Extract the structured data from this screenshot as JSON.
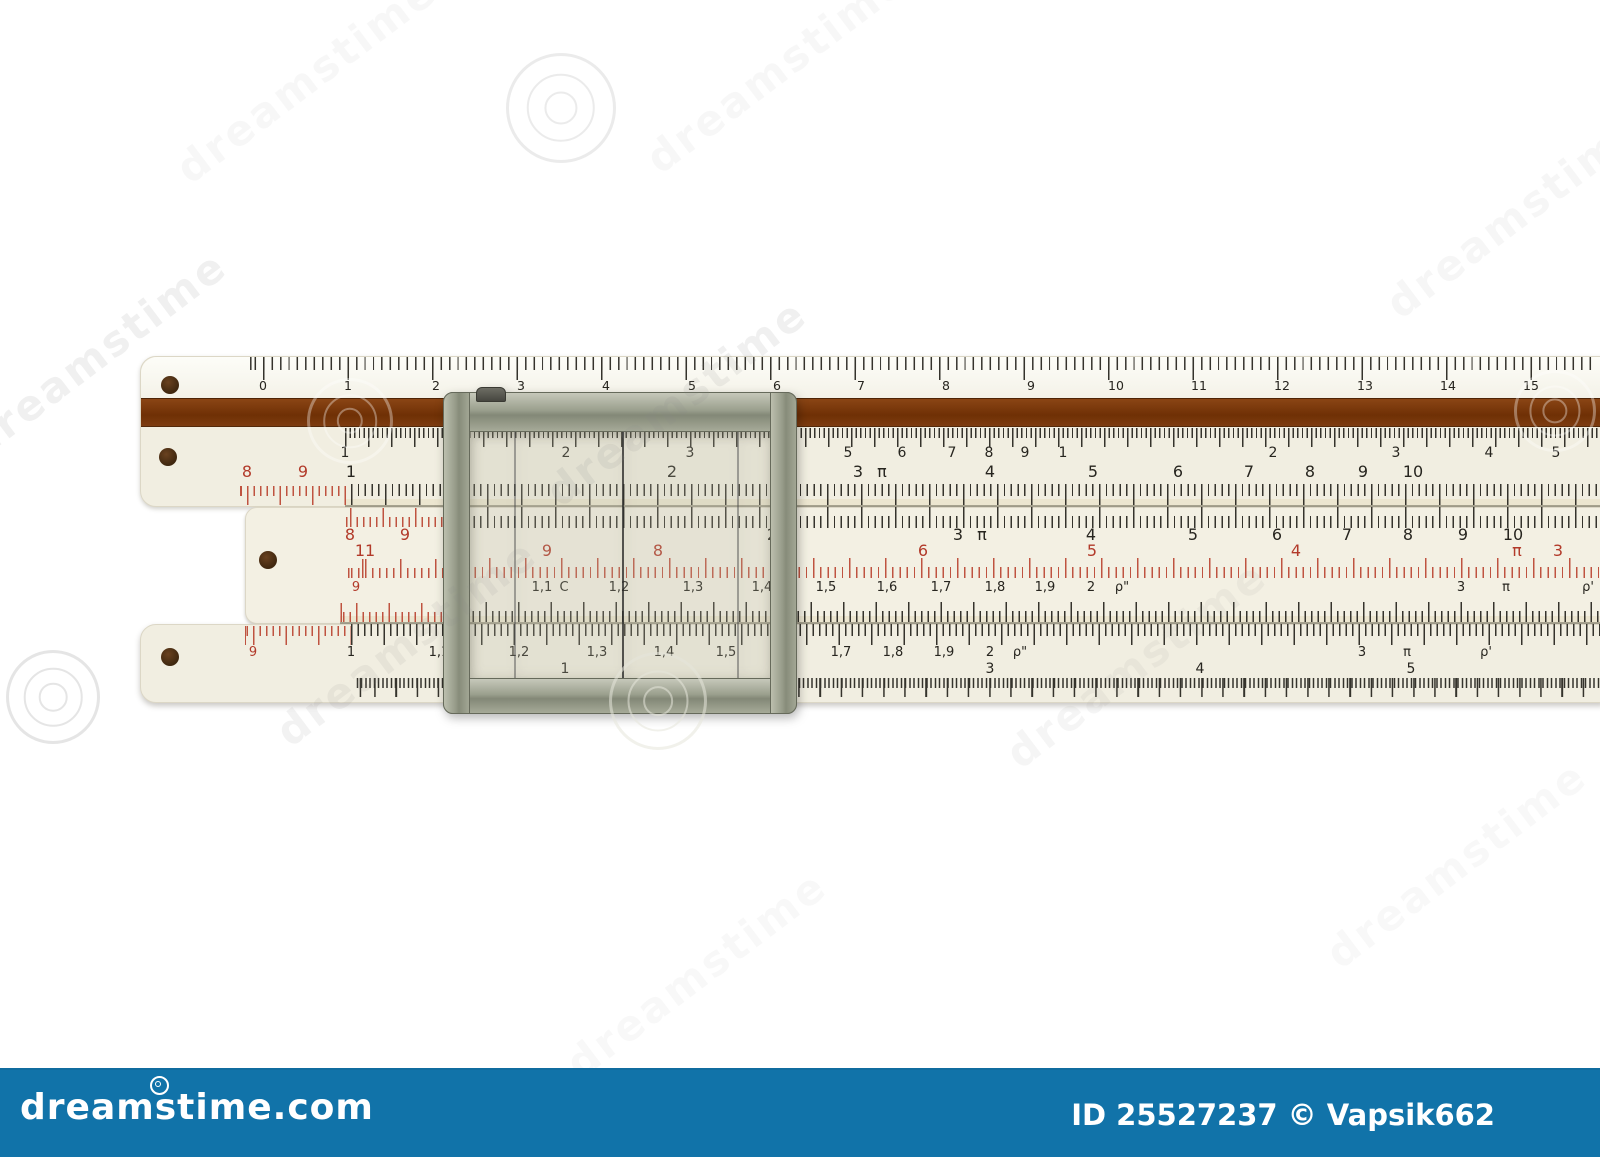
{
  "footer": {
    "logo": "dreamstime.com",
    "credit": "ID 25527237 © Vapsik662",
    "bar_color": "#1173a9"
  },
  "colors": {
    "background": "#ffffff",
    "ivory": "#f1eee1",
    "wood_brown": "#7b3a10",
    "tick_black": "#35332c",
    "tick_red": "#bf5340",
    "label_black": "#27251f",
    "label_red": "#b23a2a",
    "metal": "#9ba08e",
    "bar_blue": "#1173a9",
    "hole_brown": "#4f2e13"
  },
  "watermarks": {
    "text": "dreamstime",
    "texts": [
      {
        "x": 150,
        "y": 55,
        "o": 0.06
      },
      {
        "x": 620,
        "y": 45,
        "o": 0.06
      },
      {
        "x": -60,
        "y": 330,
        "o": 0.12
      },
      {
        "x": 520,
        "y": 378,
        "o": 0.12
      },
      {
        "x": 1360,
        "y": 190,
        "o": 0.07
      },
      {
        "x": 250,
        "y": 618,
        "o": 0.1
      },
      {
        "x": 980,
        "y": 640,
        "o": 0.08
      },
      {
        "x": 540,
        "y": 950,
        "o": 0.05
      },
      {
        "x": 1300,
        "y": 840,
        "o": 0.05
      }
    ],
    "spirals": [
      {
        "x": 558,
        "y": 105,
        "r": 52,
        "c": "rgba(190,190,190,0.30)"
      },
      {
        "x": 347,
        "y": 418,
        "r": 40,
        "c": "rgba(255,255,255,0.35)"
      },
      {
        "x": 1552,
        "y": 408,
        "r": 38,
        "c": "rgba(255,255,255,0.35)"
      },
      {
        "x": 50,
        "y": 694,
        "r": 44,
        "c": "rgba(160,160,160,0.28)"
      },
      {
        "x": 655,
        "y": 698,
        "r": 46,
        "c": "rgba(230,230,218,0.55)"
      }
    ]
  },
  "holes": [
    {
      "x": 170,
      "y": 385
    },
    {
      "x": 168,
      "y": 457
    },
    {
      "x": 268,
      "y": 560
    },
    {
      "x": 170,
      "y": 657
    }
  ],
  "strips": [
    {
      "x1": 345,
      "x2": 1600,
      "y": 499,
      "h": 7
    },
    {
      "x1": 340,
      "x2": 1600,
      "y": 616,
      "h": 7
    }
  ],
  "joints": [
    {
      "x1": 345,
      "x2": 1600,
      "y": 505
    },
    {
      "x1": 340,
      "x2": 1600,
      "y": 622
    }
  ],
  "bands": [
    {
      "id": "cm-ticks",
      "x1": 250,
      "x2": 1598,
      "y": 357,
      "h": 23,
      "minor": 8.45,
      "major": 84.5,
      "anchor": 263,
      "color": "black",
      "align": "top"
    },
    {
      "id": "cube-ticks",
      "x1": 345,
      "x2": 1600,
      "y": 428,
      "h": 19,
      "minor": 4.6,
      "major": 23,
      "anchor": 345,
      "color": "black",
      "align": "top"
    },
    {
      "id": "stator-ticks",
      "x1": 351,
      "x2": 1600,
      "y": 484,
      "h": 21,
      "minor": 6.8,
      "major": 34,
      "anchor": 351,
      "color": "black",
      "align": "top"
    },
    {
      "id": "stator-red-ext",
      "x1": 240,
      "x2": 351,
      "y": 486,
      "h": 19,
      "minor": 6.5,
      "major": 32.5,
      "anchor": 247,
      "color": "red",
      "align": "top"
    },
    {
      "id": "slide-top-ticks",
      "x1": 453,
      "x2": 1600,
      "y": 507,
      "h": 21,
      "minor": 6.8,
      "major": 34,
      "anchor": 453,
      "color": "black",
      "align": "bottom"
    },
    {
      "id": "slide-red-ext",
      "x1": 345,
      "x2": 453,
      "y": 508,
      "h": 19,
      "minor": 6.5,
      "major": 32.5,
      "anchor": 350,
      "color": "red",
      "align": "bottom"
    },
    {
      "id": "inverse-ticks",
      "x1": 453,
      "x2": 1600,
      "y": 558,
      "h": 20,
      "minor": 7.2,
      "major": 36,
      "anchor": 453,
      "color": "red",
      "align": "bottom"
    },
    {
      "id": "inverse-ext",
      "x1": 345,
      "x2": 453,
      "y": 559,
      "h": 19,
      "minor": 7,
      "major": 35,
      "anchor": 365,
      "color": "red",
      "align": "bottom"
    },
    {
      "id": "c-ticks",
      "x1": 453,
      "x2": 1600,
      "y": 602,
      "h": 20,
      "minor": 6.5,
      "major": 32.5,
      "anchor": 453,
      "color": "black",
      "align": "bottom"
    },
    {
      "id": "c-red-ext",
      "x1": 340,
      "x2": 453,
      "y": 603,
      "h": 19,
      "minor": 6.5,
      "major": 32.5,
      "anchor": 356,
      "color": "red",
      "align": "bottom"
    },
    {
      "id": "d-ticks",
      "x1": 351,
      "x2": 1600,
      "y": 624,
      "h": 21,
      "minor": 6.5,
      "major": 32.5,
      "anchor": 351,
      "color": "black",
      "align": "top"
    },
    {
      "id": "d-red-ext",
      "x1": 245,
      "x2": 351,
      "y": 626,
      "h": 19,
      "minor": 6.5,
      "major": 32.5,
      "anchor": 253,
      "color": "red",
      "align": "top"
    },
    {
      "id": "lg-ticks",
      "x1": 356,
      "x2": 1600,
      "y": 678,
      "h": 19,
      "minor": 4.25,
      "major": 21.2,
      "anchor": 565,
      "color": "black",
      "align": "top"
    }
  ],
  "scales": [
    {
      "id": "cm-scale",
      "y": 380,
      "size": 12.5,
      "labels": [
        [
          "0",
          263
        ],
        [
          "1",
          348
        ],
        [
          "2",
          436
        ],
        [
          "3",
          521
        ],
        [
          "4",
          606
        ],
        [
          "5",
          692
        ],
        [
          "6",
          777
        ],
        [
          "7",
          861
        ],
        [
          "8",
          946
        ],
        [
          "9",
          1031
        ],
        [
          "10",
          1116
        ],
        [
          "11",
          1199
        ],
        [
          "12",
          1282
        ],
        [
          "13",
          1365
        ],
        [
          "14",
          1448
        ],
        [
          "15",
          1531
        ]
      ]
    },
    {
      "id": "cube-scale",
      "y": 446,
      "size": 14,
      "labels": [
        [
          "1",
          345
        ],
        [
          "2",
          566
        ],
        [
          "3",
          690
        ],
        [
          "4",
          778
        ],
        [
          "5",
          848
        ],
        [
          "6",
          902
        ],
        [
          "7",
          952
        ],
        [
          "8",
          989
        ],
        [
          "9",
          1025
        ],
        [
          "1",
          1063
        ],
        [
          "2",
          1273
        ],
        [
          "3",
          1396
        ],
        [
          "4",
          1489
        ],
        [
          "5",
          1556
        ]
      ]
    },
    {
      "id": "stator-scale",
      "y": 464,
      "size": 16,
      "labels": [
        [
          "8",
          247,
          "r"
        ],
        [
          "9",
          303,
          "r"
        ],
        [
          "1",
          351
        ],
        [
          "2",
          672
        ],
        [
          "3",
          858
        ],
        [
          "π",
          882
        ],
        [
          "4",
          990
        ],
        [
          "5",
          1093
        ],
        [
          "6",
          1178
        ],
        [
          "7",
          1249
        ],
        [
          "8",
          1310
        ],
        [
          "9",
          1363
        ],
        [
          "10",
          1413
        ]
      ]
    },
    {
      "id": "slide-top-scale",
      "y": 527,
      "size": 16,
      "labels": [
        [
          "8",
          350,
          "r"
        ],
        [
          "9",
          405,
          "r"
        ],
        [
          "2",
          772
        ],
        [
          "3",
          958
        ],
        [
          "π",
          982
        ],
        [
          "4",
          1091
        ],
        [
          "5",
          1193
        ],
        [
          "6",
          1277
        ],
        [
          "7",
          1347
        ],
        [
          "8",
          1408
        ],
        [
          "9",
          1463
        ],
        [
          "10",
          1513
        ]
      ]
    },
    {
      "id": "inverse-scale",
      "y": 543,
      "size": 16,
      "color": "red",
      "labels": [
        [
          "11",
          365
        ],
        [
          "9",
          547
        ],
        [
          "8",
          658
        ],
        [
          "7",
          781
        ],
        [
          "6",
          923
        ],
        [
          "5",
          1092
        ],
        [
          "4",
          1296
        ],
        [
          "π",
          1517
        ],
        [
          "3",
          1558
        ]
      ]
    },
    {
      "id": "c-scale",
      "y": 581,
      "size": 13,
      "labels": [
        [
          "9",
          356,
          "r"
        ],
        [
          "1,1",
          542
        ],
        [
          "C",
          564
        ],
        [
          "1,2",
          619
        ],
        [
          "1,3",
          693
        ],
        [
          "1,4",
          762
        ],
        [
          "1,5",
          826
        ],
        [
          "1,6",
          887
        ],
        [
          "1,7",
          941
        ],
        [
          "1,8",
          995
        ],
        [
          "1,9",
          1045
        ],
        [
          "2",
          1091
        ],
        [
          "ρ\"",
          1122
        ],
        [
          "3",
          1461
        ],
        [
          "π",
          1506
        ],
        [
          "ρ'",
          1588
        ]
      ]
    },
    {
      "id": "d-scale",
      "y": 646,
      "size": 13,
      "labels": [
        [
          "9",
          253,
          "r"
        ],
        [
          "1",
          351
        ],
        [
          "1,1",
          439
        ],
        [
          "1,2",
          519
        ],
        [
          "1,3",
          597
        ],
        [
          "1,4",
          664
        ],
        [
          "1,5",
          726
        ],
        [
          "1,6",
          787
        ],
        [
          "1,7",
          841
        ],
        [
          "1,8",
          893
        ],
        [
          "1,9",
          944
        ],
        [
          "2",
          990
        ],
        [
          "ρ\"",
          1020
        ],
        [
          "3",
          1362
        ],
        [
          "π",
          1407
        ],
        [
          "ρ'",
          1486
        ]
      ]
    },
    {
      "id": "lg-scale",
      "y": 662,
      "size": 14,
      "labels": [
        [
          "1",
          565
        ],
        [
          "2",
          778
        ],
        [
          "3",
          990
        ],
        [
          "4",
          1200
        ],
        [
          "5",
          1411
        ]
      ]
    }
  ],
  "cursor": {
    "hairlines": [
      514,
      622,
      737
    ]
  }
}
